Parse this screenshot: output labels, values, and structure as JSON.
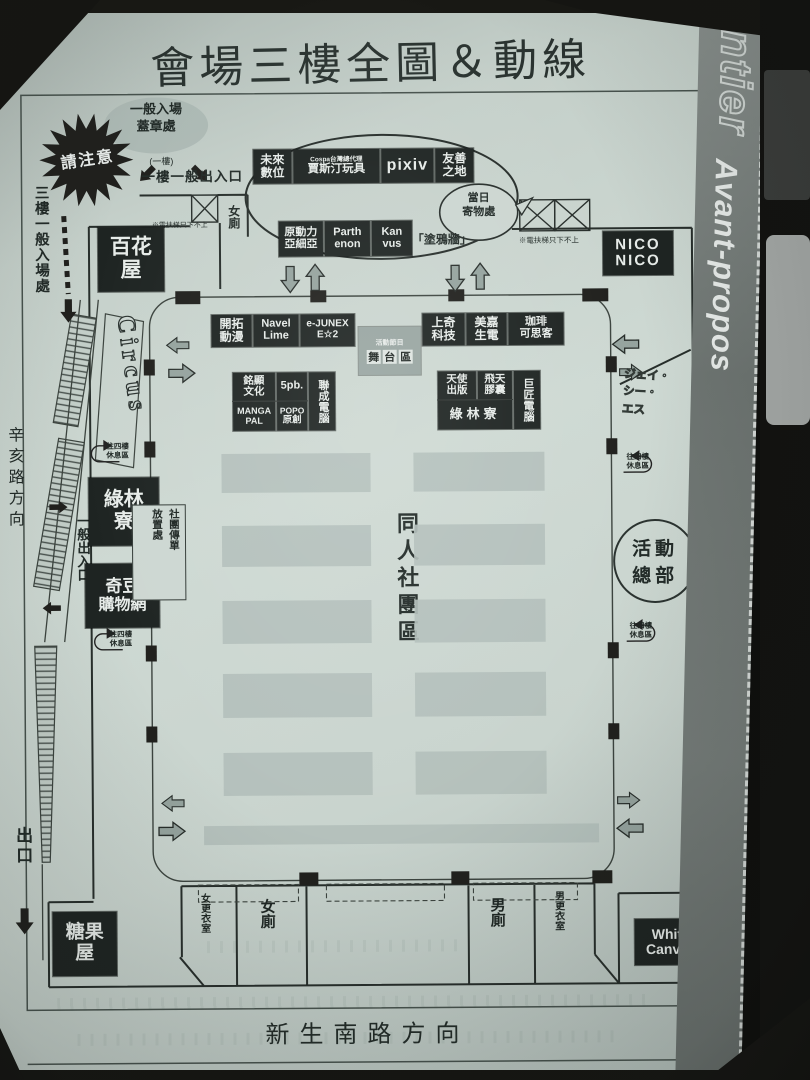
{
  "title": "會場三樓全圖＆動線",
  "magazine": {
    "brand": "fancyfrontier",
    "section": "Avant-propos"
  },
  "roads": {
    "bottom": "新生南路方向",
    "left": "辛亥路方向"
  },
  "labels": {
    "attention": "請注意",
    "stamp": [
      "一般入場",
      "蓋章處"
    ],
    "stamp_floor": "(一樓)",
    "exit_1f": "一樓一般出入口",
    "entrance_3f": "三樓一般入場處",
    "general_exit": "一般出入口",
    "exit": "出口",
    "escalator_note": "※電扶梯只下不上",
    "door_closed": "(此門封閉)",
    "rest_area": [
      "往四樓",
      "休息區"
    ],
    "deposit": [
      "當日",
      "寄物處"
    ],
    "graffiti_wall": "「塗鴉牆」",
    "flyer_stand": [
      "社團傳單",
      "放置處"
    ]
  },
  "areas": {
    "doujin_zone": "同人社團區",
    "stage_caption": "活動節目",
    "stage_tiles": [
      "舞",
      "台",
      "區"
    ],
    "hq": [
      "活動",
      "總部"
    ]
  },
  "booths": {
    "baihua": [
      "百花",
      "屋"
    ],
    "nico": [
      "NICO",
      "NICO"
    ],
    "circus": "Circus",
    "mirai": [
      "未來",
      "數位"
    ],
    "cospa": [
      "Cospa台灣總代理",
      "賈斯汀玩具"
    ],
    "pixiv": "pixiv",
    "friendly": [
      "友善",
      "之地"
    ],
    "gendouli": [
      "原動力",
      "亞細亞"
    ],
    "parthenon": [
      "Parth",
      "enon"
    ],
    "kanvus": [
      "Kan",
      "vus"
    ],
    "kaituo": [
      "開拓",
      "動漫"
    ],
    "navel": [
      "Navel",
      "Lime"
    ],
    "ejunex": [
      "e-JUNEX",
      "E☆2"
    ],
    "sunteq": [
      "上奇",
      "科技"
    ],
    "meijia": [
      "美嘉",
      "生電"
    ],
    "coffee": [
      "珈琲",
      "可思客"
    ],
    "mingxian": [
      "銘顯",
      "文化"
    ],
    "five_pb": "5pb.",
    "liancheng": "聯成電腦",
    "mangapal": [
      "MANGA",
      "PAL"
    ],
    "popo": [
      "POPO",
      "原創"
    ],
    "angel": [
      "天使",
      "出版"
    ],
    "feitian": [
      "飛天",
      "膠囊"
    ],
    "gjun": "巨匠電腦",
    "lvlin_booth": "綠林寮",
    "lvlin": [
      "綠林",
      "寮"
    ],
    "qidou": [
      "奇豆",
      "購物網"
    ],
    "candy": [
      "糖果",
      "屋"
    ],
    "white_canvas": [
      "White",
      "Canvas"
    ],
    "jcs": [
      "ジェイ・",
      "シー・",
      "エス"
    ]
  },
  "rooms": {
    "toilet_f_top": "女廁",
    "change_f": "女更衣室",
    "toilet_f": "女廁",
    "toilet_m": "男廁",
    "change_m": "男更衣室"
  }
}
